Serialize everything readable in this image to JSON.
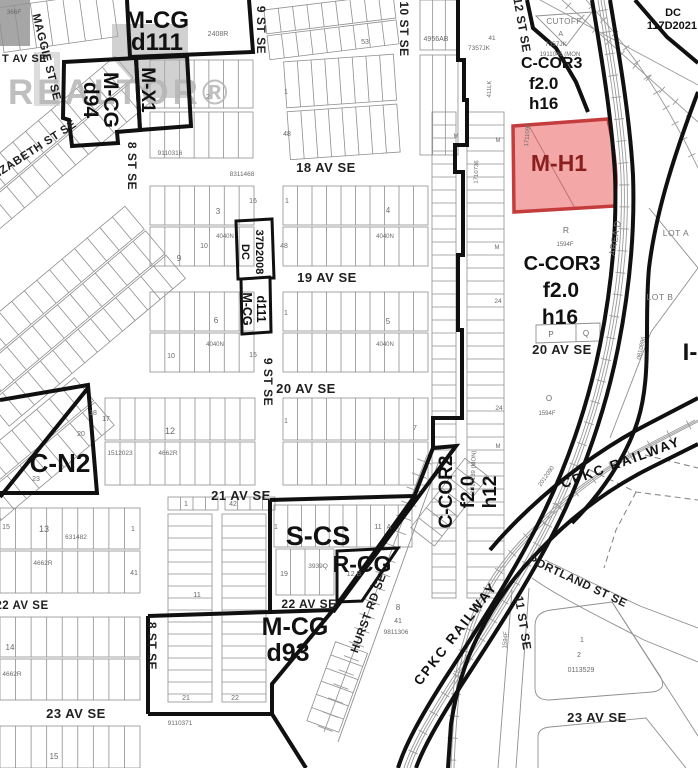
{
  "watermark": {
    "logo_text": "REALTOR®"
  },
  "colors": {
    "highlight_fill": "#e85050",
    "highlight_stroke": "#c43c3c"
  },
  "zones": {
    "mcg_d111_top_1": "M-CG",
    "mcg_d111_top_2": "d111",
    "mcg_d94_1": "M-CG",
    "mcg_d94_2": "d94",
    "mx1": "M-X1",
    "ccor3_top_1": "C-COR3",
    "ccor3_top_2": "f2.0",
    "ccor3_top_3": "h16",
    "dc117_1": "DC",
    "dc117_2": "117D2021",
    "mh1": "M-H1",
    "ccor3_mid_1": "C-COR3",
    "ccor3_mid_2": "f2.0",
    "ccor3_mid_3": "h16",
    "dc37_1": "DC",
    "dc37_2": "37D2008",
    "mcg_d111_mid_1": "M-CG",
    "mcg_d111_mid_2": "d111",
    "cn2": "C-N2",
    "ccor2_1": "C-COR2",
    "ccor2_2": "f2.0",
    "ccor2_3": "h12",
    "scs": "S-CS",
    "rcg": "R-CG",
    "mcg_d93_1": "M-CG",
    "mcg_d93_2": "d93",
    "ig": "I-"
  },
  "streets": {
    "maggie": "MAGGIE ST SE",
    "t_av": "T AV SE",
    "elizabeth": "ELIZABETH ST SE",
    "st8_top": "8 ST SE",
    "st9_top": "9 ST SE",
    "st9_mid": "9 ST SE",
    "st10": "10 ST SE",
    "st12": "12 ST SE",
    "av18": "18 AV SE",
    "av19": "19 AV SE",
    "av20_w": "20 AV SE",
    "av20_e": "20 AV SE",
    "av21": "21 AV SE",
    "av22_w": "22 AV SE",
    "av22_m": "22 AV SE",
    "av23_w": "23 AV SE",
    "av23_e": "23 AV SE",
    "st8_bot": "8 ST SE",
    "st11": "11 ST SE",
    "hurst": "HURST RD SE",
    "portland": "PORTLAND ST SE"
  },
  "railway": {
    "ne": "CPKC RAILWAY",
    "sw": "CPKC RAILWAY"
  },
  "areas": {
    "lot_a": "LOT A",
    "lot_b": "LOT B",
    "area_d": "AREA D",
    "cutoff": "CUTOFF",
    "cutoff_lot": "A"
  },
  "parcels": {
    "p7357jk": "7357JK",
    "p1911046": "1911046 (MON",
    "p2408r": "2408R",
    "p4956ab": "4956AB",
    "p53": "53",
    "p366f": "366F",
    "p9110316": "9110316",
    "p8311468": "8311468",
    "pr": "R",
    "pp": "P",
    "pq": "Q",
    "po": "O",
    "p1594f": "1594F",
    "p4040n": "4040N",
    "p1512023": "1512023",
    "p4662r": "4662R",
    "p631482": "631482",
    "p3939q": "3939Q",
    "p12b": "12 B",
    "p9811306": "9811306",
    "p0113529": "0113529",
    "p9110371": "9110371",
    "p2012090": "2012090",
    "p0810896": "0810896",
    "p1710736": "1710736",
    "p1710139": "1710139 (MON)",
    "p411lk": "411LK",
    "p1711090": "1711090",
    "pM": "M",
    "nA": "A",
    "n1": "1",
    "n2": "2",
    "n3": "3",
    "n4": "4",
    "n5": "5",
    "n6": "6",
    "n7": "7",
    "n8": "8",
    "n9": "9",
    "n10": "10",
    "n11": "11",
    "n12": "12",
    "n13": "13",
    "n14": "14",
    "n15": "15",
    "n16": "16",
    "n17": "17",
    "n18": "18",
    "n19": "19",
    "n20": "20",
    "n21": "21",
    "n22": "22",
    "n23": "23",
    "n24": "24",
    "n41": "41",
    "n42": "42",
    "n48": "48"
  }
}
